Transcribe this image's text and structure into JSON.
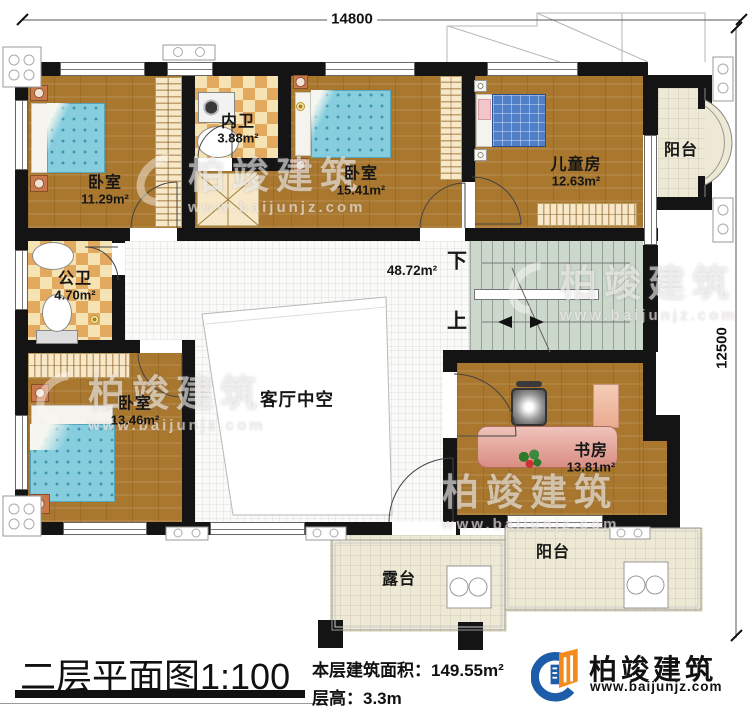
{
  "dimensions": {
    "top": "14800",
    "right": "12500"
  },
  "rooms": {
    "bedroom1": {
      "name": "卧室",
      "area": "11.29m²"
    },
    "inner_bath": {
      "name": "内卫",
      "area": "3.88m²"
    },
    "bedroom2": {
      "name": "卧室",
      "area": "15.41m²"
    },
    "kids_room": {
      "name": "儿童房",
      "area": "12.63m²"
    },
    "balcony_right": {
      "name": "阳台"
    },
    "public_bath": {
      "name": "公卫",
      "area": "4.70m²"
    },
    "hall": {
      "area": "48.72m²"
    },
    "bedroom3": {
      "name": "卧室",
      "area": "13.46m²"
    },
    "living_void": {
      "name": "客厅中空"
    },
    "study": {
      "name": "书房",
      "area": "13.81m²"
    },
    "balcony_bottom": {
      "name": "阳台"
    },
    "terrace": {
      "name": "露台"
    }
  },
  "stairs": {
    "down": "下",
    "up": "上"
  },
  "titleblock": {
    "title": "二层平面图",
    "scale": "1:100",
    "floor_area_label": "本层建筑面积：",
    "floor_area_value": "149.55m²",
    "floor_height_label": "层高：",
    "floor_height_value": "3.3m"
  },
  "logo": {
    "name": "柏竣建筑",
    "url": "www.baijunjz.com"
  },
  "watermark": {
    "name": "柏竣建筑",
    "url": "www.baijunjz.com"
  }
}
